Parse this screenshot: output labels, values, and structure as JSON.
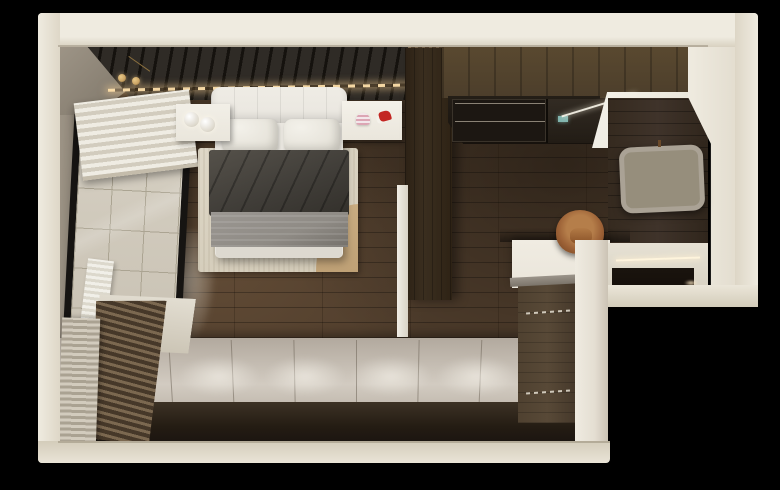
{
  "scene": {
    "type": "3d-interior-render",
    "view": "top-down-cutaway",
    "subject": "L-shaped studio apartment with bedroom, kitchenette and entry",
    "background": "black"
  },
  "palette": {
    "bg": "#000000",
    "wall_cream": "#e9e4d7",
    "wall_gray": "#9e9587",
    "slat": "#2f2b26",
    "gold": "#c9a263",
    "floor_wood": "#4f3d2c",
    "floor_dark": "#3c2e20",
    "tile": "#cbc4b6",
    "grout": "#aba492",
    "win_black": "#161412",
    "platform": "#b2a99e",
    "platform_light": "#d2cbc1",
    "platform_face": "#3d3225",
    "rug": "#ded7c7",
    "rug_accent": "#c9ac81",
    "bed_white": "#e9e6df",
    "duvet": "#413e39",
    "blanket": "#8f8b85",
    "sheet": "#ddd9d0",
    "nightstand": "#eae6dc",
    "pink": "#dca6b4",
    "accent_red": "#c32622",
    "wardrobe": "#3a2e1f",
    "cabinet": "#4c3e2b",
    "base_cab": "#584937",
    "wall_planks": "#3f332a",
    "win_frame": "#aaa295",
    "muntin": "#968e7c",
    "frosted": "#f7f5ee",
    "screen_teal": "#7fb3ad",
    "chair": "#9c6136",
    "chair_light": "#b57e4a",
    "chair_dark": "#6e3f1d",
    "counter": "#eae5da",
    "column": "#e4ded2",
    "recess": "#150f0a",
    "glow_warm": "#ffe9c4"
  },
  "counts": {
    "mugs_per_row": 6,
    "mug_rows": 2,
    "window_panes": 8,
    "plank_lines": 8,
    "light_pools": 5
  },
  "rooms": [
    {
      "name": "bedroom",
      "items": [
        "double-bed",
        "tufted-headboard",
        "two-pillows",
        "charcoal-duvet",
        "gray-blanket",
        "area-rug",
        "tan-rug-accent",
        "nightstand-left-with-two-sphere-lamps",
        "nightstand-right-with-pink-lamp-and-red-decor",
        "slat-accent-wall-with-led-strip",
        "gold-pendant-lights",
        "balcony-window-with-roller-blind",
        "radiator",
        "wood-slat-blind",
        "raised-platform"
      ]
    },
    {
      "name": "kitchen-hall",
      "items": [
        "upper-cabinets",
        "hanging-mug-rack",
        "cooktop-panel",
        "ceiling-light-panel",
        "grid-window",
        "desk-counter",
        "leather-desk-chair",
        "base-cabinet",
        "entry-steps-with-led"
      ]
    }
  ]
}
